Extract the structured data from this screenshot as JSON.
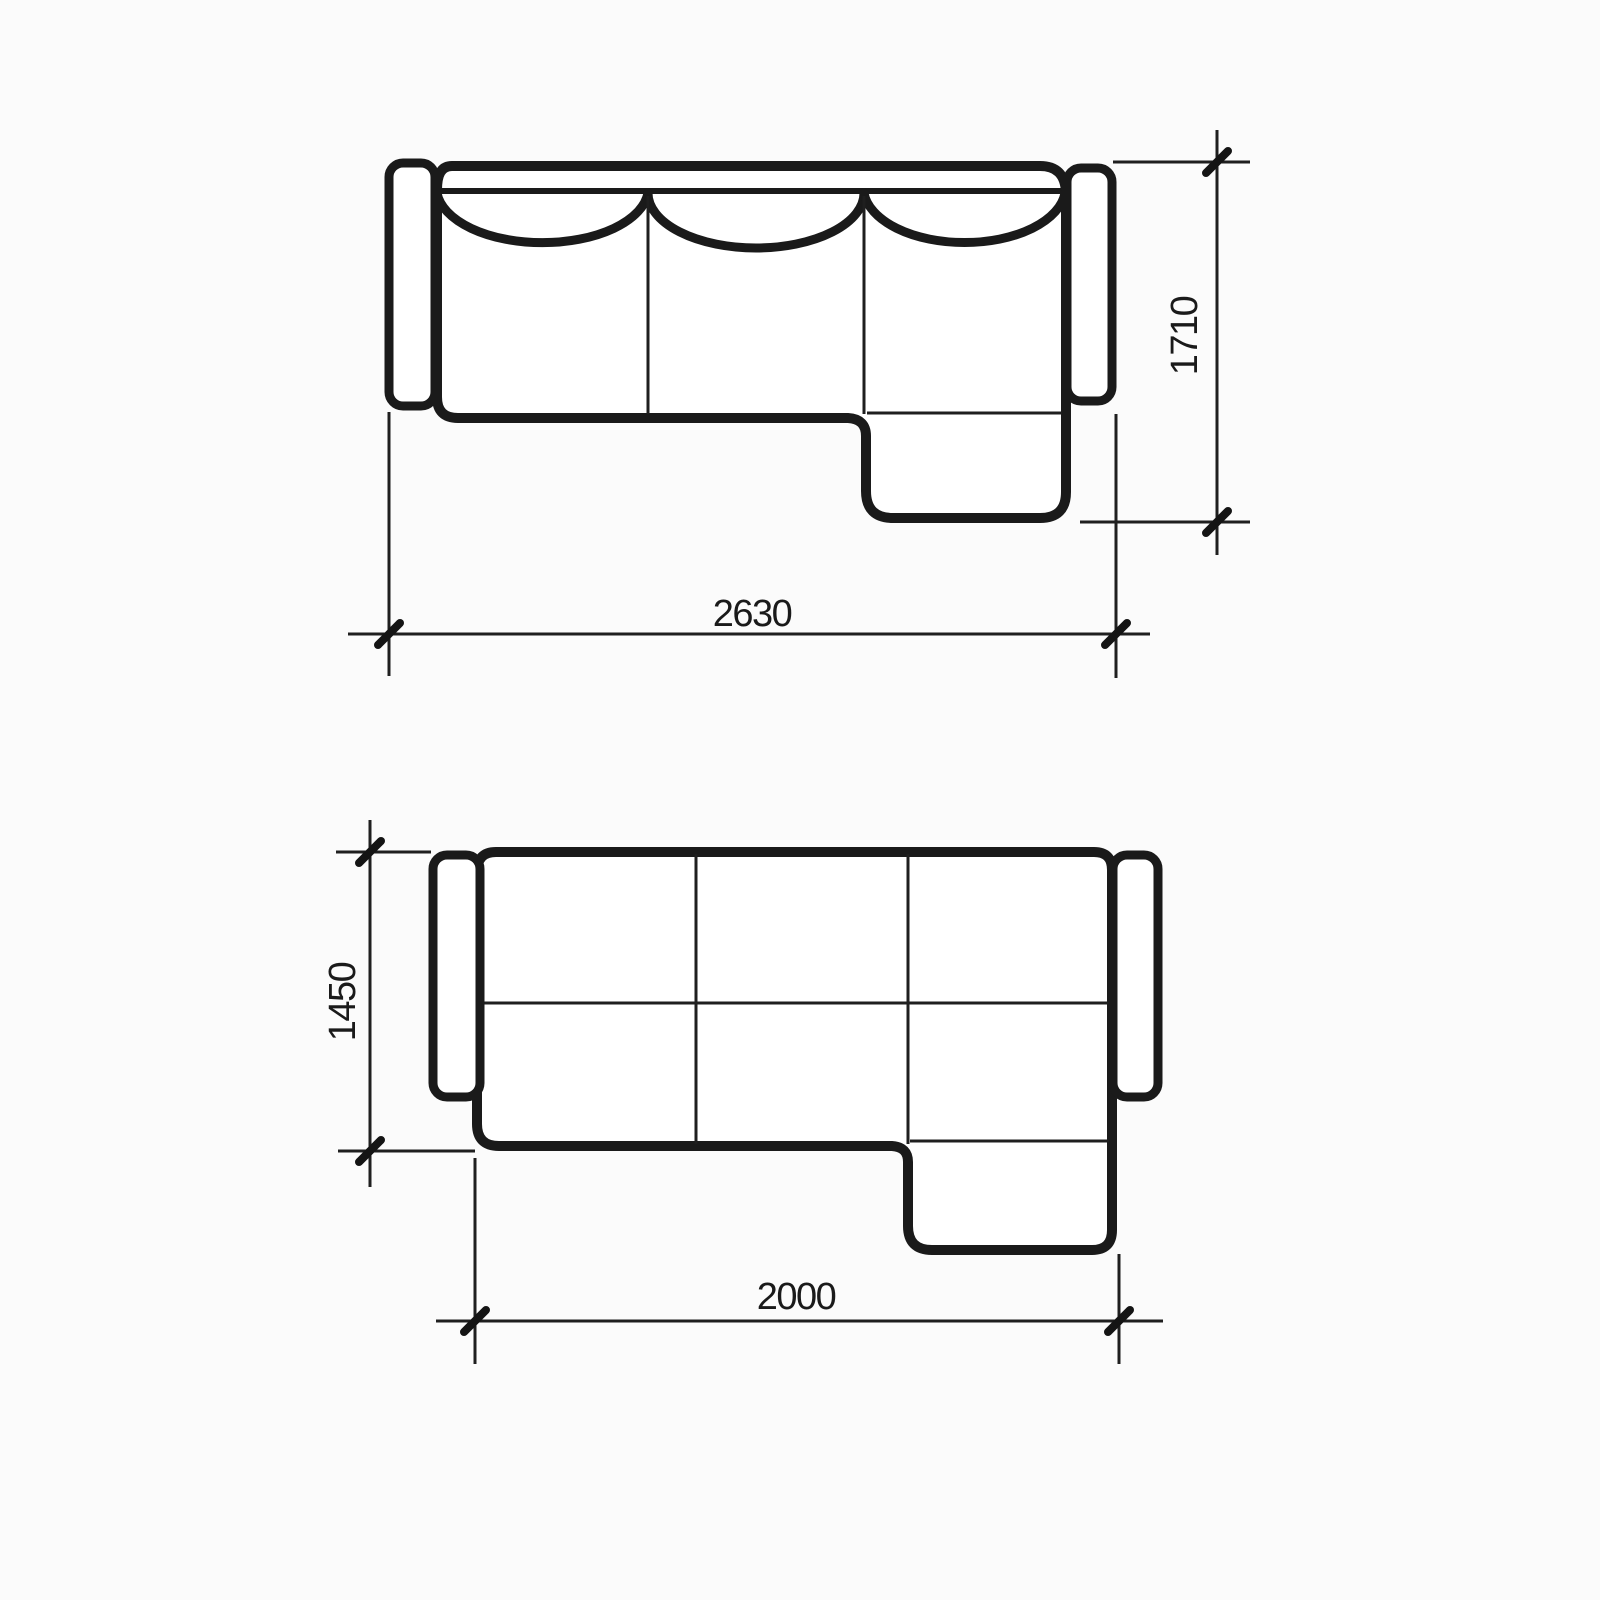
{
  "colors": {
    "background": "#fbfbfb",
    "line": "#1a1a1a"
  },
  "sofa_view": {
    "width": "2630",
    "depth": "1710"
  },
  "bed_view": {
    "width": "2000",
    "depth": "1450"
  }
}
